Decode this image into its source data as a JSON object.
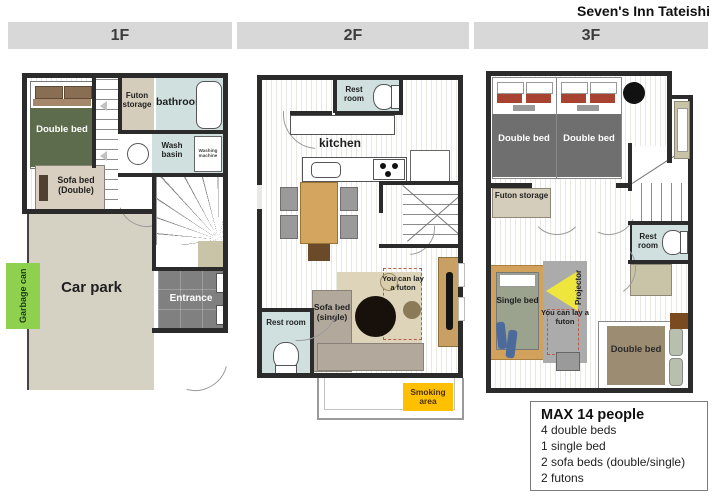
{
  "title": "Seven's Inn Tateishi",
  "floor1": {
    "header": "1F",
    "labels": {
      "double_bed": "Double bed",
      "futon_storage": "Futon storage",
      "bathroom": "bathroom",
      "wash_basin": "Wash basin",
      "washing_machine": "Washing machine",
      "sofa_bed": "Sofa bed (Double)",
      "car_park": "Car park",
      "entrance": "Entrance",
      "garbage_can": "Garbage can"
    }
  },
  "floor2": {
    "header": "2F",
    "labels": {
      "rest_room_top": "Rest room",
      "kitchen": "kitchen",
      "sofa_bed": "Sofa bed (single)",
      "futon_note": "You can lay a futon",
      "rest_room_bottom": "Rest room",
      "smoking_area": "Smoking area"
    }
  },
  "floor3": {
    "header": "3F",
    "labels": {
      "double_bed_left": "Double bed",
      "double_bed_right": "Double bed",
      "futon_storage": "Futon storage",
      "rest_room": "Rest room",
      "single_bed": "Single bed",
      "projector": "Projector",
      "futon_note": "You can lay a futon",
      "double_bed_bottom": "Double bed"
    }
  },
  "info_box": {
    "title": "MAX 14 people",
    "lines": [
      "4 double beds",
      "1 single bed",
      "2 sofa beds (double/single)",
      "2 futons"
    ]
  },
  "colors": {
    "header_bg": "#d8d8d8",
    "wall": "#2b2b2b",
    "water_room_blue": "#cfe0df",
    "bed_green": "#5c6c4c",
    "bed_dark_gray": "#6f6f6f",
    "bed_taupe": "#9c8c72",
    "sofa_beige": "#d9cfc0",
    "sofa_gray": "#b2a89c",
    "futon_storage_beige": "#d5cdbb",
    "car_park_beige": "#d5d1c3",
    "entrance_gray": "#808080",
    "garbage_green": "#8ed14f",
    "smoking_yellow": "#fec000",
    "table_tan": "#d3a55e",
    "rug_beige": "#ddd4ba",
    "rug_gray": "#ababab",
    "projector_yellow": "#eee63c",
    "pillow_red": "#a84332",
    "chair_blue": "#4c6b9a"
  }
}
